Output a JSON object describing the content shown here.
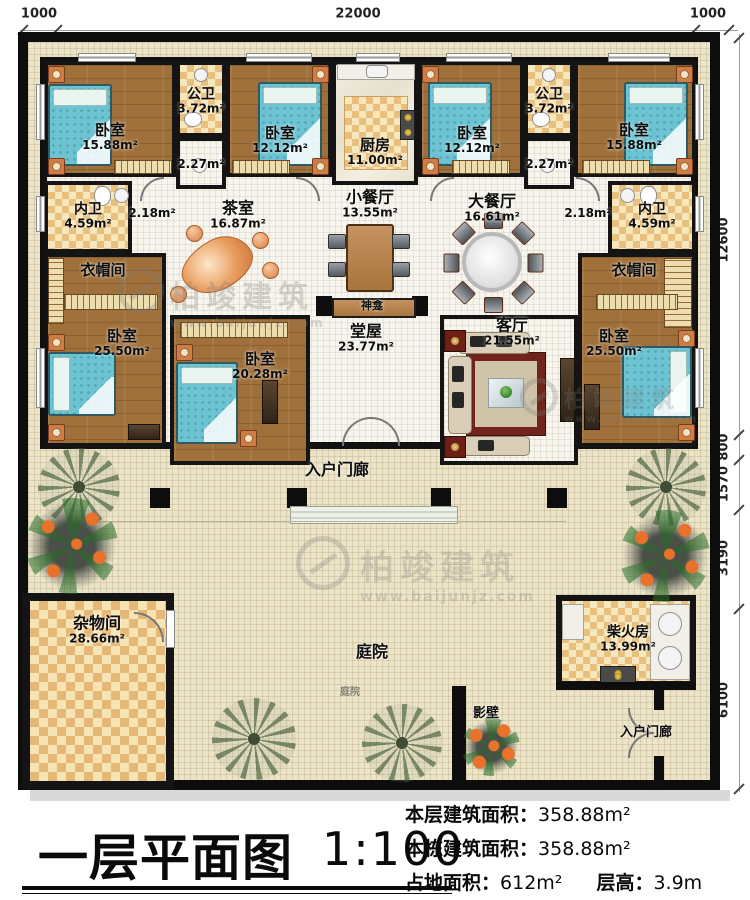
{
  "title_block": {
    "title": "一层平面图",
    "scale": "1:100",
    "info": [
      {
        "label": "本层建筑面积：",
        "value": "358.88m²"
      },
      {
        "label": "本栋建筑面积：",
        "value": "358.88m²"
      },
      {
        "label": "占地面积：",
        "value": "612m²"
      },
      {
        "label": "层高：",
        "value": "3.9m"
      }
    ]
  },
  "dims": {
    "top": [
      "1000",
      "22000",
      "1000"
    ],
    "right": [
      "12600",
      "800",
      "1570",
      "3190",
      "6100"
    ]
  },
  "rooms": {
    "bedroom_tl": {
      "name": "卧室",
      "area": "15.88m²"
    },
    "pubbath_l": {
      "name": "公卫",
      "area": "3.72m²"
    },
    "passage_l": {
      "area": "2.27m²"
    },
    "bedroom_tl2": {
      "name": "卧室",
      "area": "12.12m²"
    },
    "kitchen": {
      "name": "厨房",
      "area": "11.00m²"
    },
    "bedroom_tr2": {
      "name": "卧室",
      "area": "12.12m²"
    },
    "pubbath_r": {
      "name": "公卫",
      "area": "3.72m²"
    },
    "passage_r": {
      "area": "2.27m²"
    },
    "bedroom_tr": {
      "name": "卧室",
      "area": "15.88m²"
    },
    "innerbath_l": {
      "name": "内卫",
      "area": "4.59m²"
    },
    "hall_l": {
      "area": "2.18m²"
    },
    "tea_room": {
      "name": "茶室",
      "area": "16.87m²"
    },
    "small_dining": {
      "name": "小餐厅",
      "area": "13.55m²"
    },
    "shrine": {
      "name": "神龛"
    },
    "big_dining": {
      "name": "大餐厅",
      "area": "16.61m²"
    },
    "hall_r": {
      "area": "2.18m²"
    },
    "innerbath_r": {
      "name": "内卫",
      "area": "4.59m²"
    },
    "cloak_l": {
      "name": "衣帽间"
    },
    "cloak_r": {
      "name": "衣帽间"
    },
    "bedroom_ml": {
      "name": "卧室",
      "area": "25.50m²"
    },
    "bedroom_mc": {
      "name": "卧室",
      "area": "20.28m²"
    },
    "main_hall": {
      "name": "堂屋",
      "area": "23.77m²"
    },
    "living": {
      "name": "客厅",
      "area": "21.55m²"
    },
    "bedroom_mr": {
      "name": "卧室",
      "area": "25.50m²"
    },
    "porch": {
      "name": "入户门廊"
    },
    "storage": {
      "name": "杂物间",
      "area": "28.66m²"
    },
    "courtyard": {
      "name": "庭院"
    },
    "firewood": {
      "name": "柴火房",
      "area": "13.99m²"
    },
    "screen_wall": {
      "name": "影壁"
    },
    "porch_se": {
      "name": "入户门廊"
    }
  },
  "watermark": {
    "brand": "柏竣建筑",
    "url": "www.baijunjz.com"
  },
  "colors": {
    "wall": "#0d0d0d",
    "wood_floor": "#a0703a",
    "tile_checker": "#e8bf7c",
    "bed": "#6ec3d2",
    "site_floor": "#ebe4c9",
    "rug": "#70241c"
  }
}
